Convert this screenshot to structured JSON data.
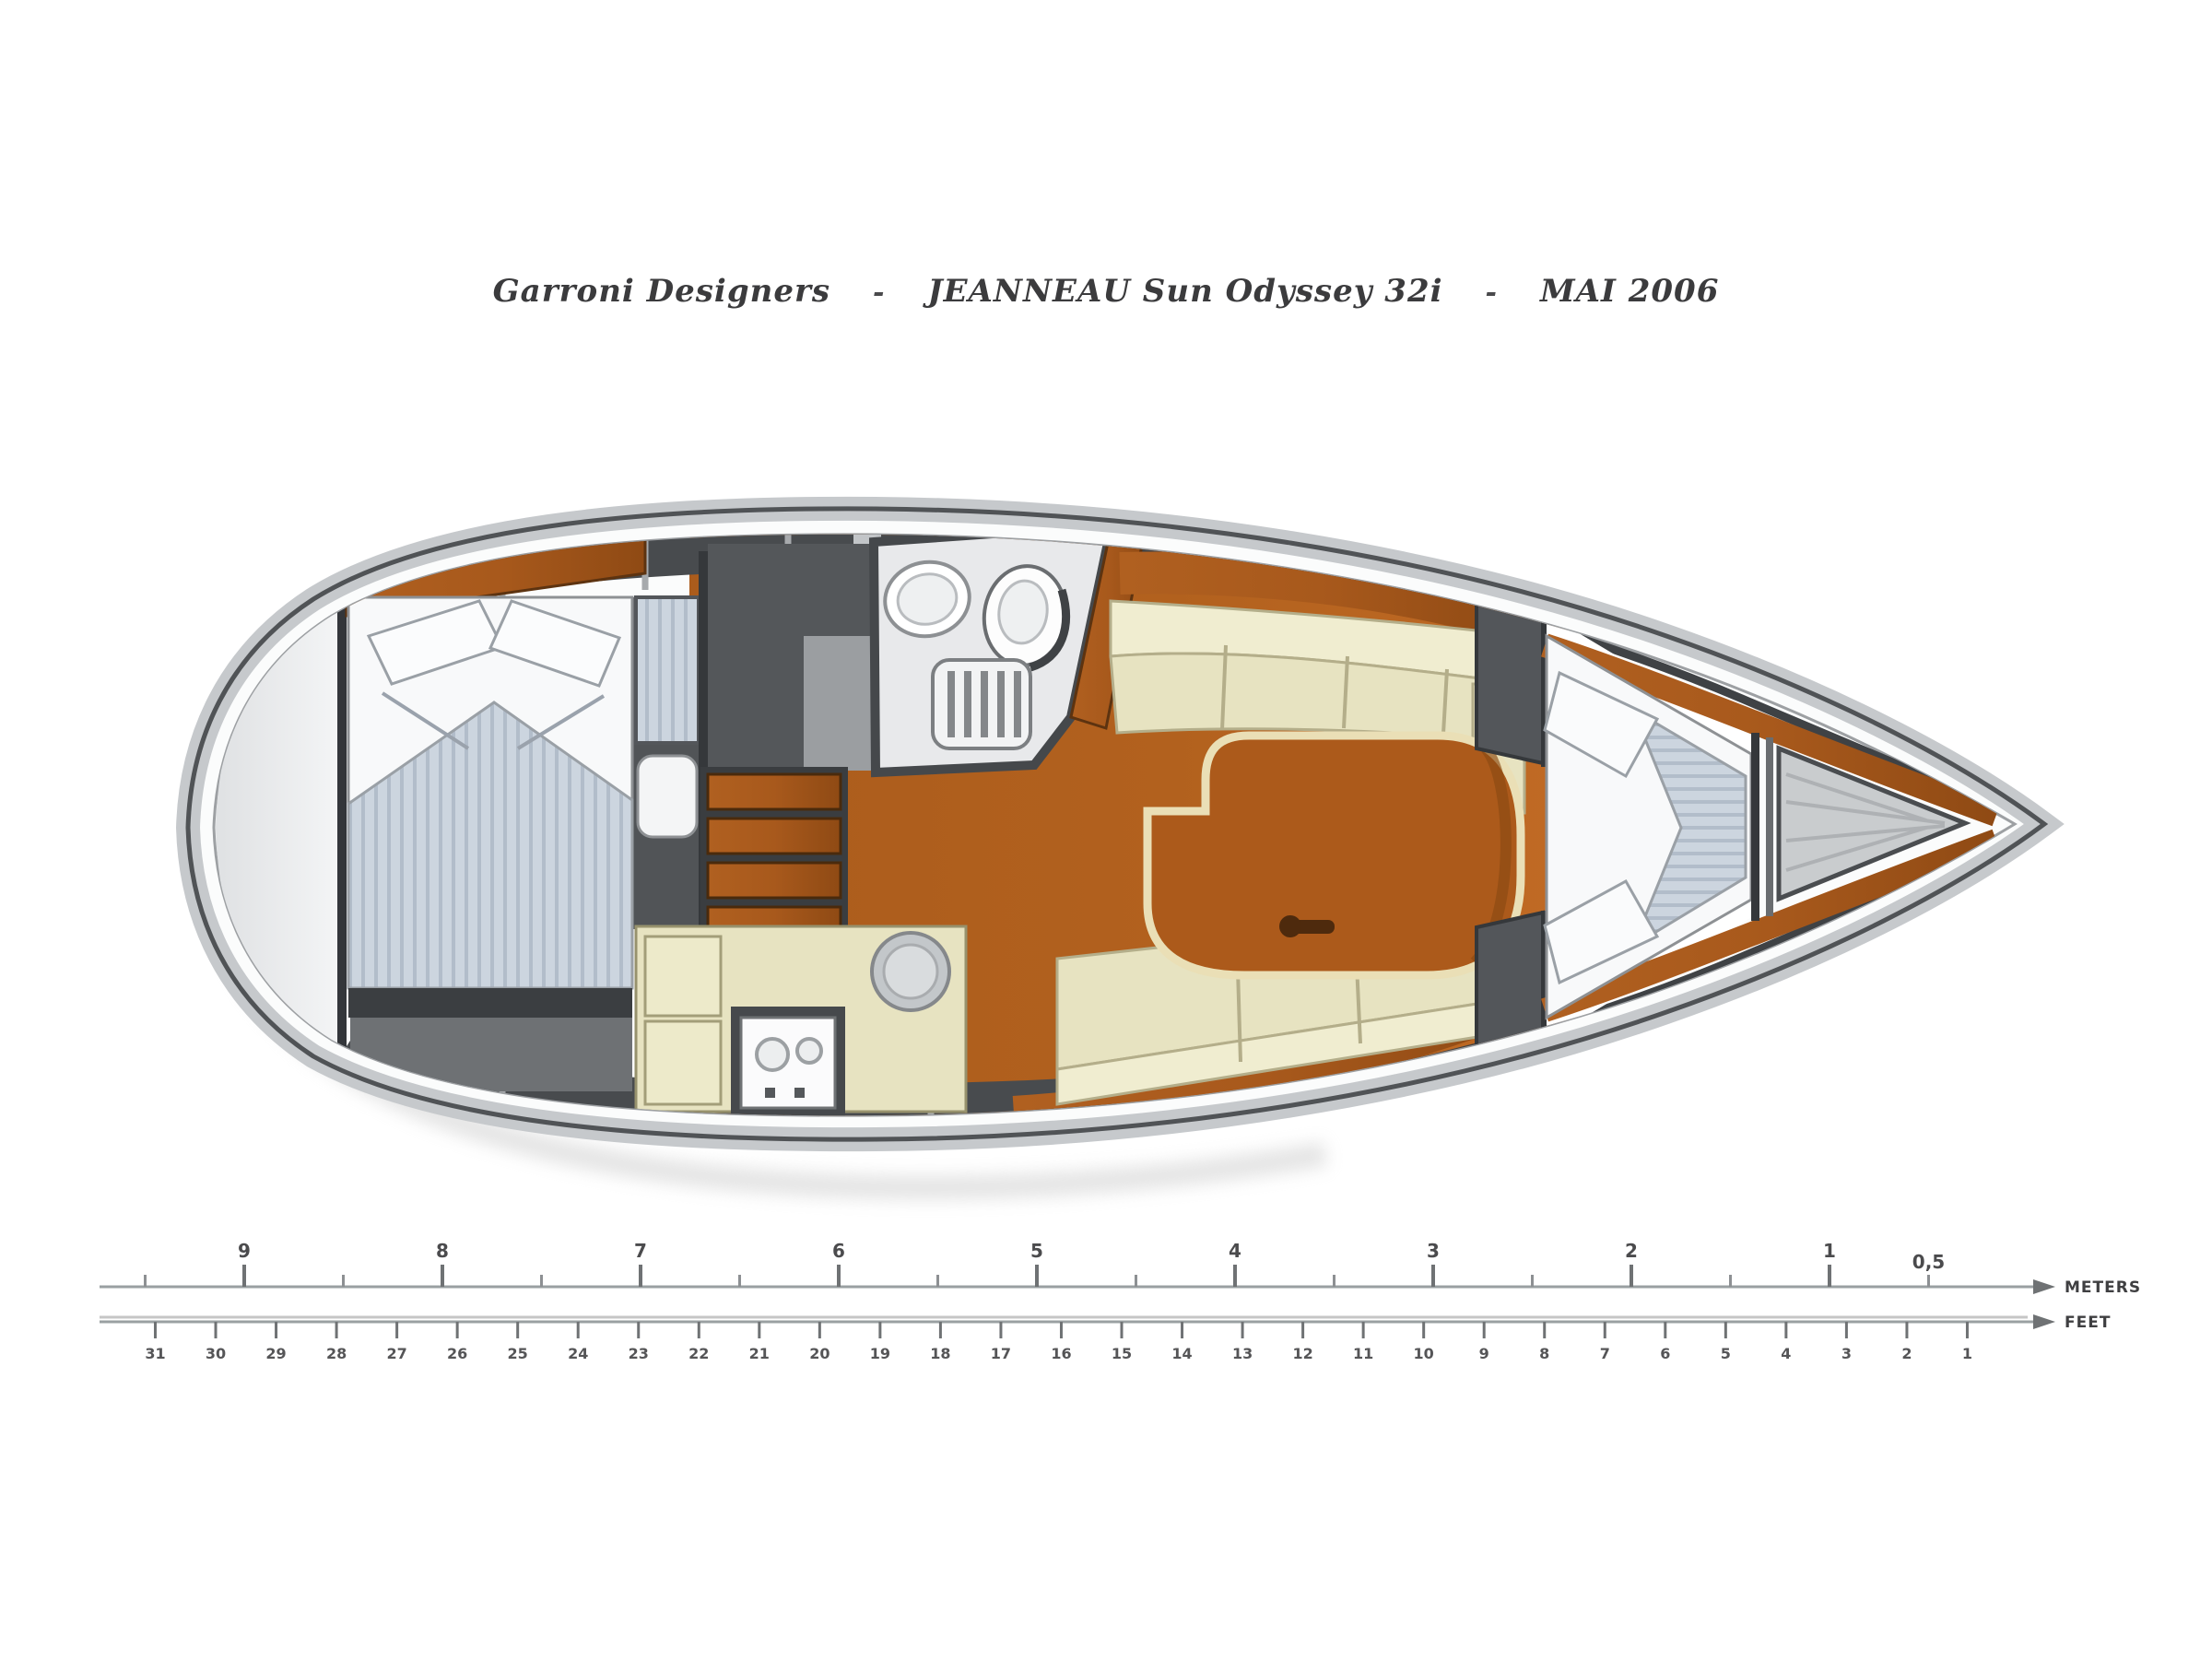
{
  "title": {
    "designer": "Garroni Designers",
    "separator": "-",
    "model": "JEANNEAU Sun Odyssey 32i",
    "date": "MAI 2006"
  },
  "scale_ruler": {
    "meters": {
      "label": "METERS",
      "major_tick_labels": [
        "9",
        "8",
        "7",
        "6",
        "5",
        "4",
        "3",
        "2",
        "1"
      ],
      "half_tick_label": "0,5"
    },
    "feet": {
      "label": "FEET",
      "tick_labels": [
        "31",
        "30",
        "29",
        "28",
        "27",
        "26",
        "25",
        "24",
        "23",
        "22",
        "21",
        "20",
        "19",
        "18",
        "17",
        "16",
        "15",
        "14",
        "13",
        "12",
        "11",
        "10",
        "9",
        "8",
        "7",
        "6",
        "5",
        "4",
        "3",
        "2",
        "1"
      ]
    }
  },
  "icons": {
    "toilet": "toilet-icon",
    "sink": "sink-icon",
    "stove": "stove-icon",
    "steps": "companionway-steps-icon"
  },
  "colors": {
    "floor_wood": "#b2611e",
    "furniture_wood": "#a8591c",
    "table_wood": "#ac5a1b",
    "settee_cream": "#e7e3c1",
    "settee_back_cream": "#f0edd0",
    "mattress_blue": "#ccd5df",
    "mattress_stripe": "#b2bdca",
    "structure_dark": "#46494c",
    "hull_rim_gray": "#c6c9cc",
    "outline_dark": "#505356",
    "title_text": "#3b3b3d",
    "ruler_line": "#9aa0a2"
  }
}
